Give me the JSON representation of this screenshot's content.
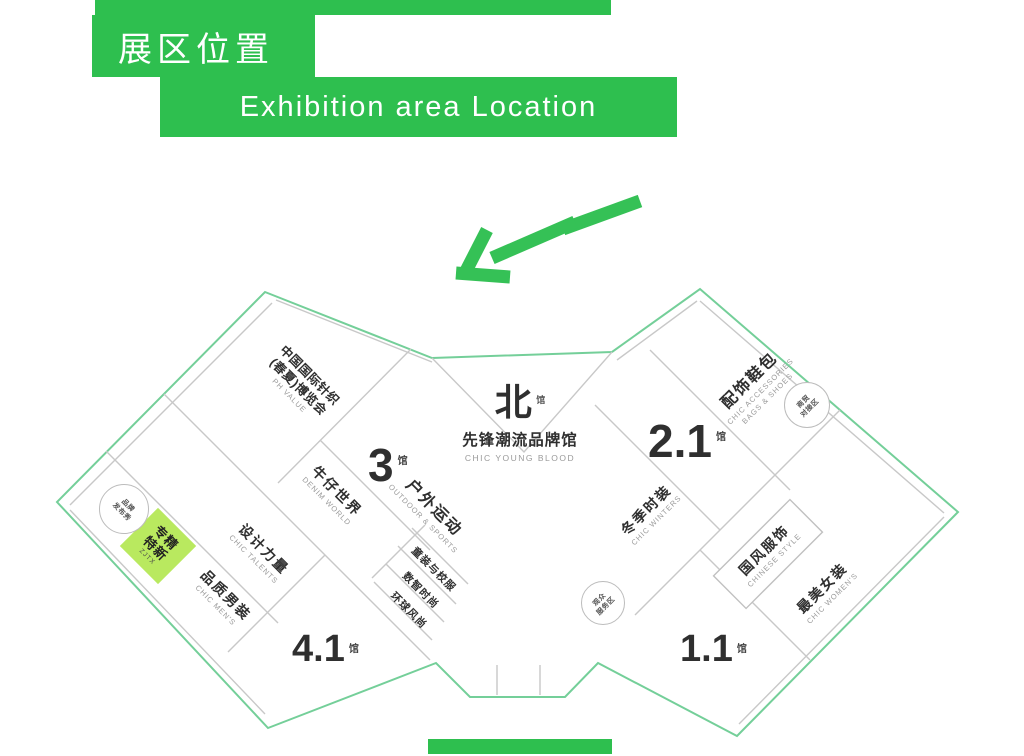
{
  "header": {
    "title_zh": "展区位置",
    "title_en": "Exhibition area Location"
  },
  "colors": {
    "brand_green": "#2ebf4f",
    "highlight_green": "#b9e95f",
    "outline_green": "#74cf99",
    "line_gray": "#c8c8c8",
    "text_dark": "#2f2f2f",
    "text_gray": "#9a9a9a"
  },
  "north_hall": {
    "name_zh": "北",
    "hall_suffix": "馆",
    "title_zh": "先锋潮流品牌馆",
    "title_en": "CHIC YOUNG BLOOD"
  },
  "halls": [
    {
      "number": "3",
      "suffix": "馆"
    },
    {
      "number": "4.1",
      "suffix": "馆"
    },
    {
      "number": "2.1",
      "suffix": "馆"
    },
    {
      "number": "1.1",
      "suffix": "馆"
    }
  ],
  "zones_left": [
    {
      "zh": "中国国际针织",
      "zh2": "(春夏)博览会",
      "en": "PH VALUE"
    },
    {
      "zh": "牛仔世界",
      "en": "DENIM WORLD"
    },
    {
      "zh": "户外运动",
      "en": "OUTDOOR & SPORTS"
    },
    {
      "zh": "童装与校服"
    },
    {
      "zh": "数智时尚"
    },
    {
      "zh": "环球风尚"
    },
    {
      "zh": "设计力量",
      "en": "CHIC TALENTS"
    },
    {
      "zh": "品质男装",
      "en": "CHIC MEN'S"
    }
  ],
  "zones_right": [
    {
      "zh": "配饰鞋包",
      "en": "CHIC ACCESSORIES",
      "en2": "BAGS & SHOES"
    },
    {
      "zh": "冬季时装",
      "en": "CHIC WINTERS"
    },
    {
      "zh": "国风服饰",
      "en": "CHINESE STYLE"
    },
    {
      "zh": "最美女装",
      "en": "CHIC WOMEN'S"
    }
  ],
  "highlight_block": {
    "line1": "专精",
    "line2": "特新",
    "en": "ZJTX"
  },
  "badges": [
    {
      "line1": "品牌",
      "line2": "发布秀"
    },
    {
      "line1": "商贸",
      "line2": "对接区"
    },
    {
      "line1": "观众",
      "line2": "服务区"
    }
  ]
}
